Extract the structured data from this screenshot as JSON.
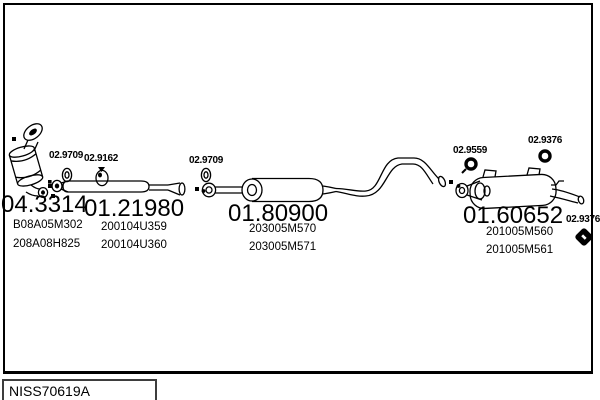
{
  "diagram": {
    "code": "NISS70619A",
    "colors": {
      "line": "#000000",
      "background": "#ffffff",
      "code_box_border": "#3d3d3d"
    },
    "parts": [
      {
        "number": "04.3314",
        "refs": [
          "B08A05M302",
          "208A08H825"
        ]
      },
      {
        "number": "01.21980",
        "refs": [
          "200104U359",
          "200104U360"
        ]
      },
      {
        "number": "01.80900",
        "refs": [
          "203005M570",
          "203005M571"
        ]
      },
      {
        "number": "01.60652",
        "refs": [
          "201005M560",
          "201005M561"
        ]
      }
    ],
    "hardware": [
      {
        "number": "02.9709",
        "icon": "gasket-ring-icon"
      },
      {
        "number": "02.9162",
        "icon": "pipe-clamp-icon"
      },
      {
        "number": "02.9709",
        "icon": "gasket-ring-icon"
      },
      {
        "number": "02.9559",
        "icon": "rubber-mount-icon"
      },
      {
        "number": "02.9376",
        "icon": "rubber-mount-icon"
      },
      {
        "number": "02.9376",
        "icon": "rubber-mount-icon"
      }
    ]
  }
}
